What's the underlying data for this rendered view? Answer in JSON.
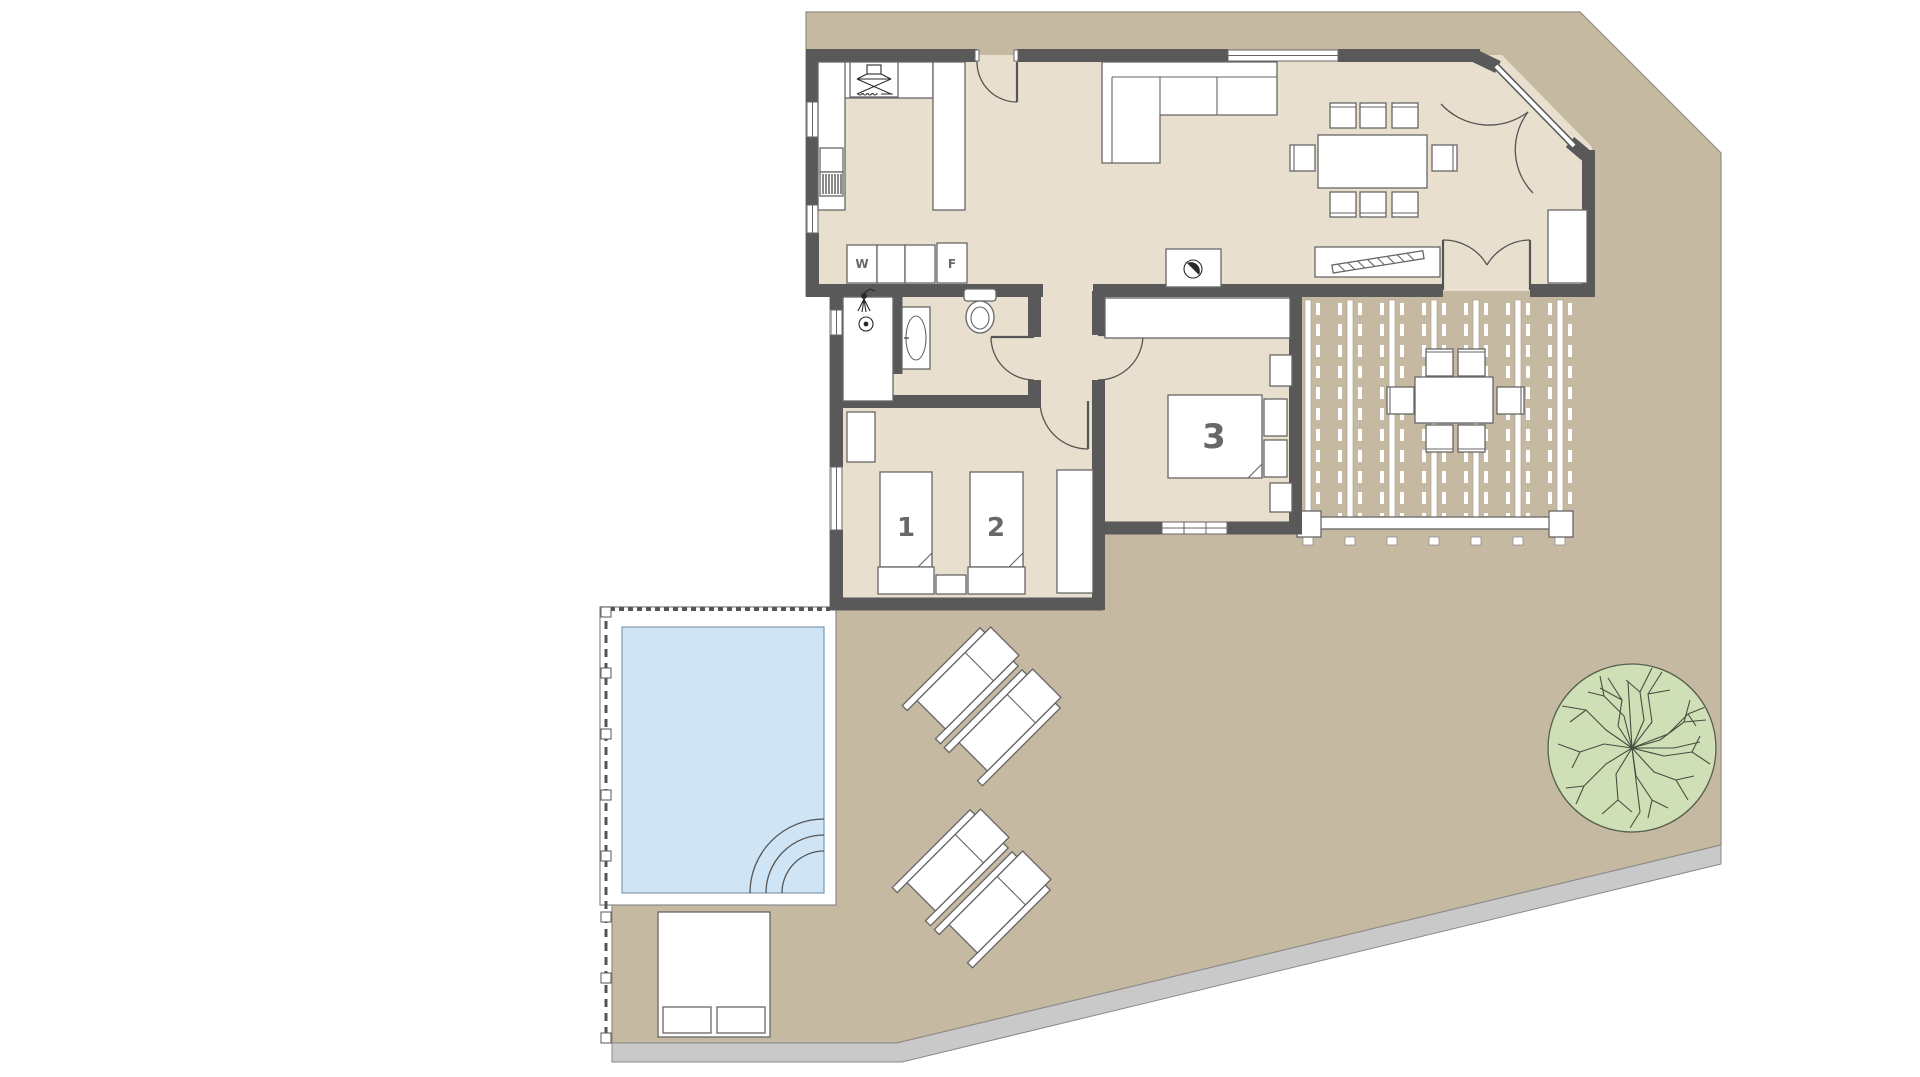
{
  "document": {
    "type": "architectural-floor-plan",
    "background": "#ffffff"
  },
  "labels": {
    "bedroom_1": "1",
    "bedroom_2": "2",
    "bedroom_3": "3",
    "washing_machine": "W",
    "fridge": "F"
  },
  "colors": {
    "terrace": "#c6b9a2",
    "interior_floor": "#e8dfce",
    "wall": "#595959",
    "pool_water": "#cfe4f5",
    "pool_deck": "#ffffff",
    "tree_foliage": "#cfe0b6",
    "perimeter_path": "#c9c9c9",
    "furniture_fill": "#ffffff",
    "furniture_stroke": "#666666",
    "label_text": "#686868"
  }
}
